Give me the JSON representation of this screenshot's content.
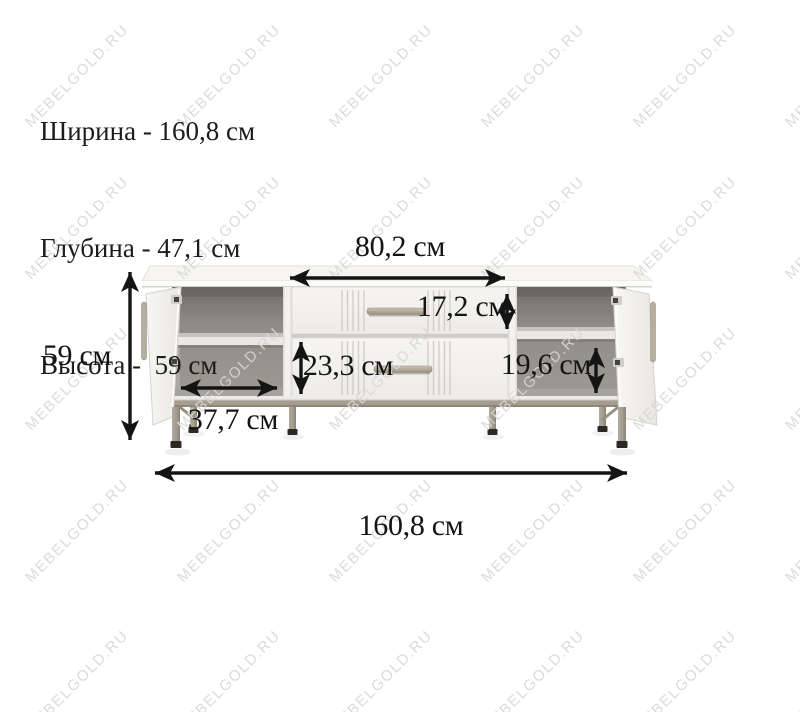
{
  "page": {
    "background": "#ffffff",
    "type": "product-dimension-diagram"
  },
  "watermark": {
    "text": "MEBELGOLD.RU",
    "color": "#d7d7d7",
    "rows": 5,
    "cols": 6,
    "x_start": 77,
    "y_start": 76,
    "x_step": 152,
    "y_step": 151.5,
    "angle_deg": -45
  },
  "specs": {
    "lines": [
      "Ширина - 160,8 см",
      "Глубина - 47,1 см",
      "Высота -  59 см"
    ]
  },
  "diagram": {
    "unit": "см",
    "dimensions": {
      "drawer_section_width": "80,2 см",
      "top_drawer_height": "17,2 см",
      "bottom_drawer_height": "23,3 см",
      "right_shelf_height": "19,6 см",
      "left_compartment_width": "37,7 см",
      "height": "59 см",
      "overall_width": "160,8 см"
    },
    "colors": {
      "dimension_line": "#141414",
      "body_white": "#f1f0ed",
      "interior_gray": "#8f8c86",
      "metal_champagne": "#a7a093",
      "foot_dark": "#2b2925"
    }
  }
}
